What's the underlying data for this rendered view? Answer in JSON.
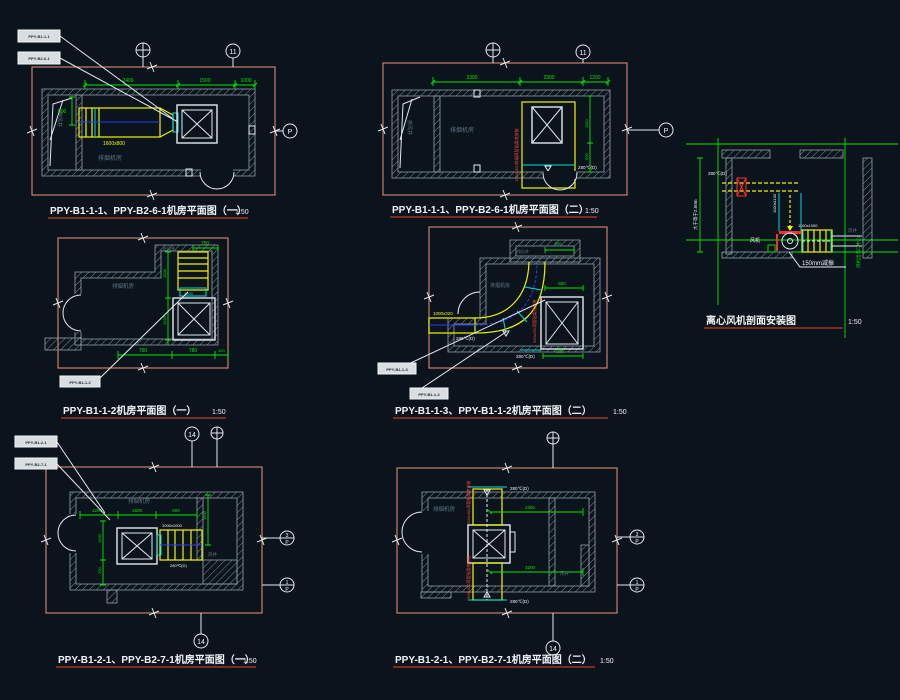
{
  "palette": {
    "background": "#0b141d",
    "dimension_green": "#00e600",
    "duct_yellow": "#f2f200",
    "damper_cyan": "#00dcdc",
    "annotation_red": "#ff2d2d",
    "frame_salmon": "#c97f68",
    "wall_gray": "#93a1ab",
    "text_white": "#eef3f6",
    "text_faint_gray": "#5d7482",
    "title_underline": "#a03524"
  },
  "drawings": {
    "a": {
      "title": "PPY-B1-1-1、PPY-B2-6-1机房平面图（一）",
      "scale": "1:50",
      "tags": [
        "PPY-B1-1-1",
        "PPY-B2-6-1"
      ],
      "room": "排烟机房",
      "shaft": "排风井",
      "duct_size": "1600x800",
      "dims": [
        "2400",
        "1500",
        "1000",
        "500"
      ],
      "grid": {
        "right": "11",
        "section": "P"
      }
    },
    "b": {
      "title": "PPY-B1-1-1、PPY-B2-6-1机房平面图（二）",
      "scale": "1:50",
      "room": "排烟机房",
      "shaft": "排风井",
      "damper": "280℃(D)",
      "note": "1250x400排烟风管贴梁底安装",
      "dims": [
        "3300",
        "2300",
        "1200",
        "1100",
        "500"
      ],
      "grid": {
        "right": "11",
        "section": "P"
      }
    },
    "c": {
      "title": "离心风机剖面安装图",
      "scale": "1:50",
      "damper": "280℃(D)",
      "duct1": "1100x1100",
      "duct2": "1100x1000",
      "fan": "风机",
      "shaft": "风井",
      "note_vibration": "150mm减振",
      "dim_height": "大于等于2.50m",
      "centerline": "风机出风口中心"
    },
    "d": {
      "title": "PPY-B1-1-2机房平面图（一）",
      "scale": "1:50",
      "tags": [
        "PPY-B1-1-2"
      ],
      "room": "排烟机房",
      "inlet": "进风井",
      "connector": "2500",
      "dims": [
        "750",
        "760",
        "780",
        "100",
        "1500",
        "1250"
      ]
    },
    "e": {
      "title": "PPY-B1-1-3、PPY-B1-1-2机房平面图（二）",
      "scale": "1:50",
      "tags": [
        "PPY-B1-1-3",
        "PPY-B1-1-2"
      ],
      "room": "排烟机房",
      "shaft": "排风井",
      "damper": "280℃(D)",
      "duct_size": "1000x320",
      "note": "320x250风管贴梁底安装",
      "dims": [
        "500",
        "800",
        "900"
      ]
    },
    "f": {
      "title": "PPY-B1-2-1、PPY-B2-7-1机房平面图（一）",
      "scale": "1:50",
      "tags": [
        "PPY-B1-2-1",
        "PPY-B2-7-1"
      ],
      "room": "排烟机房",
      "shaft": "风井",
      "fan_size": "1000x1000",
      "damper": "280℃(D)",
      "dims": [
        "1200",
        "1500",
        "600",
        "1500",
        "700",
        "1500"
      ],
      "grid": {
        "top": "14",
        "bottom": "14",
        "p1_num": "3",
        "p2_num": "1",
        "p": "P"
      }
    },
    "g": {
      "title": "PPY-B1-2-1、PPY-B2-7-1机房平面图（二）",
      "scale": "1:50",
      "room": "排烟机房",
      "shaft": "风井",
      "damper": "280℃(D)",
      "note_top": "500x400风管贴梁底安装",
      "note_bottom": "500x400风管贴梁底安装",
      "dims": [
        "2300",
        "3200"
      ],
      "grid": {
        "bottom": "14",
        "p1_num": "3",
        "p2_num": "1",
        "p": "P"
      }
    }
  }
}
